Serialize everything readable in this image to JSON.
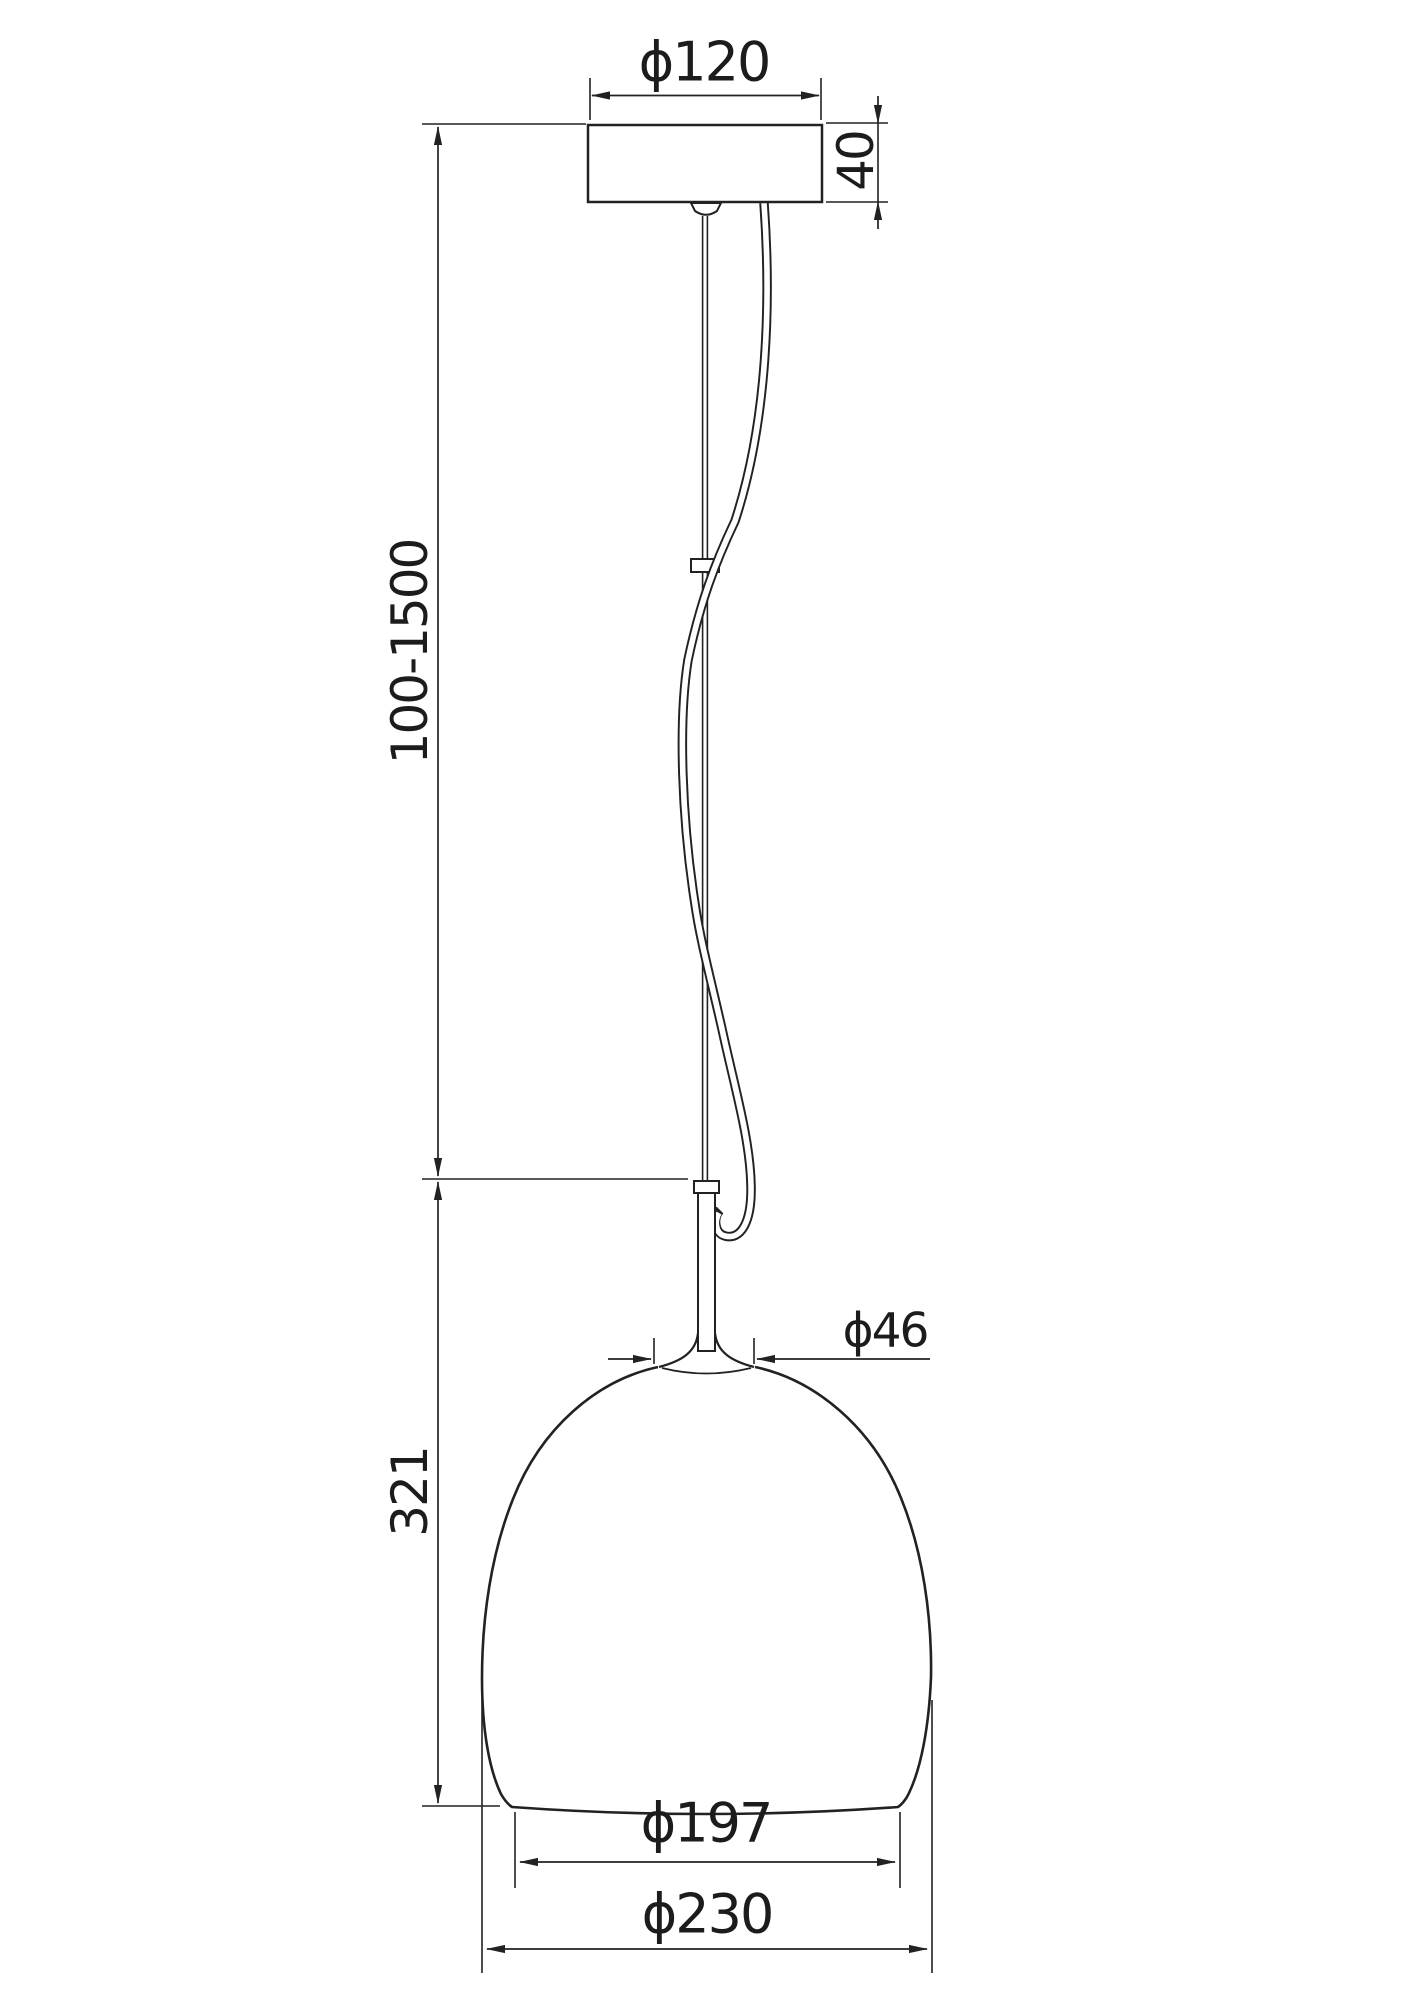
{
  "drawing": {
    "title": "pendant-lamp-dimension-drawing",
    "line_color": "#222222",
    "background_color": "#ffffff",
    "labels": {
      "canopy_diameter": "ϕ120",
      "canopy_height": "40",
      "suspension_length": "100-1500",
      "neck_diameter": "ϕ46",
      "shade_height": "321",
      "shade_opening_diameter": "ϕ197",
      "shade_diameter": "ϕ230"
    },
    "dimensions": [
      {
        "name": "canopy diameter",
        "value": "120",
        "unit_symbol": "ϕ"
      },
      {
        "name": "canopy height",
        "value": "40"
      },
      {
        "name": "adjustable suspension length",
        "value": "100-1500"
      },
      {
        "name": "neck diameter",
        "value": "46",
        "unit_symbol": "ϕ"
      },
      {
        "name": "shade height",
        "value": "321"
      },
      {
        "name": "shade opening diameter",
        "value": "197",
        "unit_symbol": "ϕ"
      },
      {
        "name": "shade max diameter",
        "value": "230",
        "unit_symbol": "ϕ"
      }
    ]
  }
}
